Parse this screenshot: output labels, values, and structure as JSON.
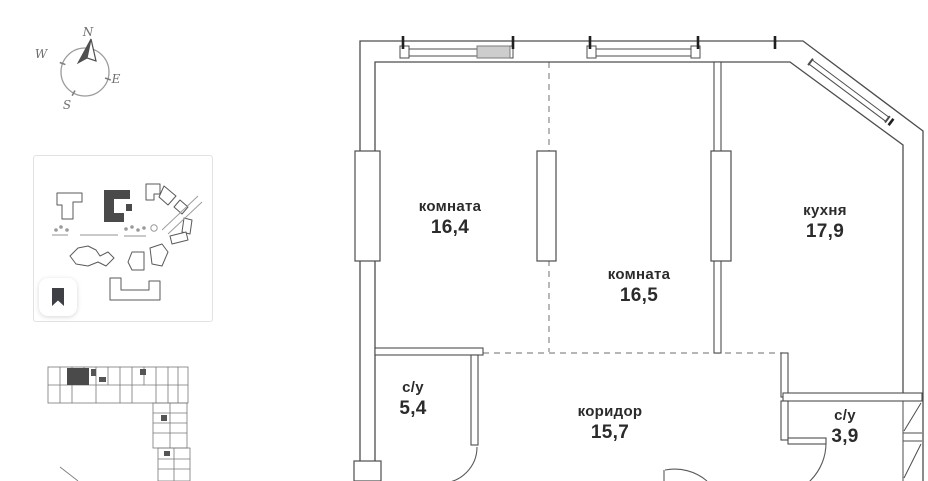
{
  "compass": {
    "north": "N",
    "west": "W",
    "east": "E",
    "south": "S"
  },
  "icons": {
    "bookmark": "bookmark-icon",
    "compass": "compass-rose-icon"
  },
  "rooms": [
    {
      "name": "комната",
      "area": "16,4"
    },
    {
      "name": "комната",
      "area": "16,5"
    },
    {
      "name": "кухня",
      "area": "17,9"
    },
    {
      "name": "с/у",
      "area": "5,4"
    },
    {
      "name": "коридор",
      "area": "15,7"
    },
    {
      "name": "с/у",
      "area": "3,9"
    }
  ],
  "colors": {
    "wall_line": "#4d4d4d",
    "dashed_line": "#8a8a8a",
    "label_text": "#2b2b2b",
    "highlight_fill": "#4a4a4a"
  }
}
